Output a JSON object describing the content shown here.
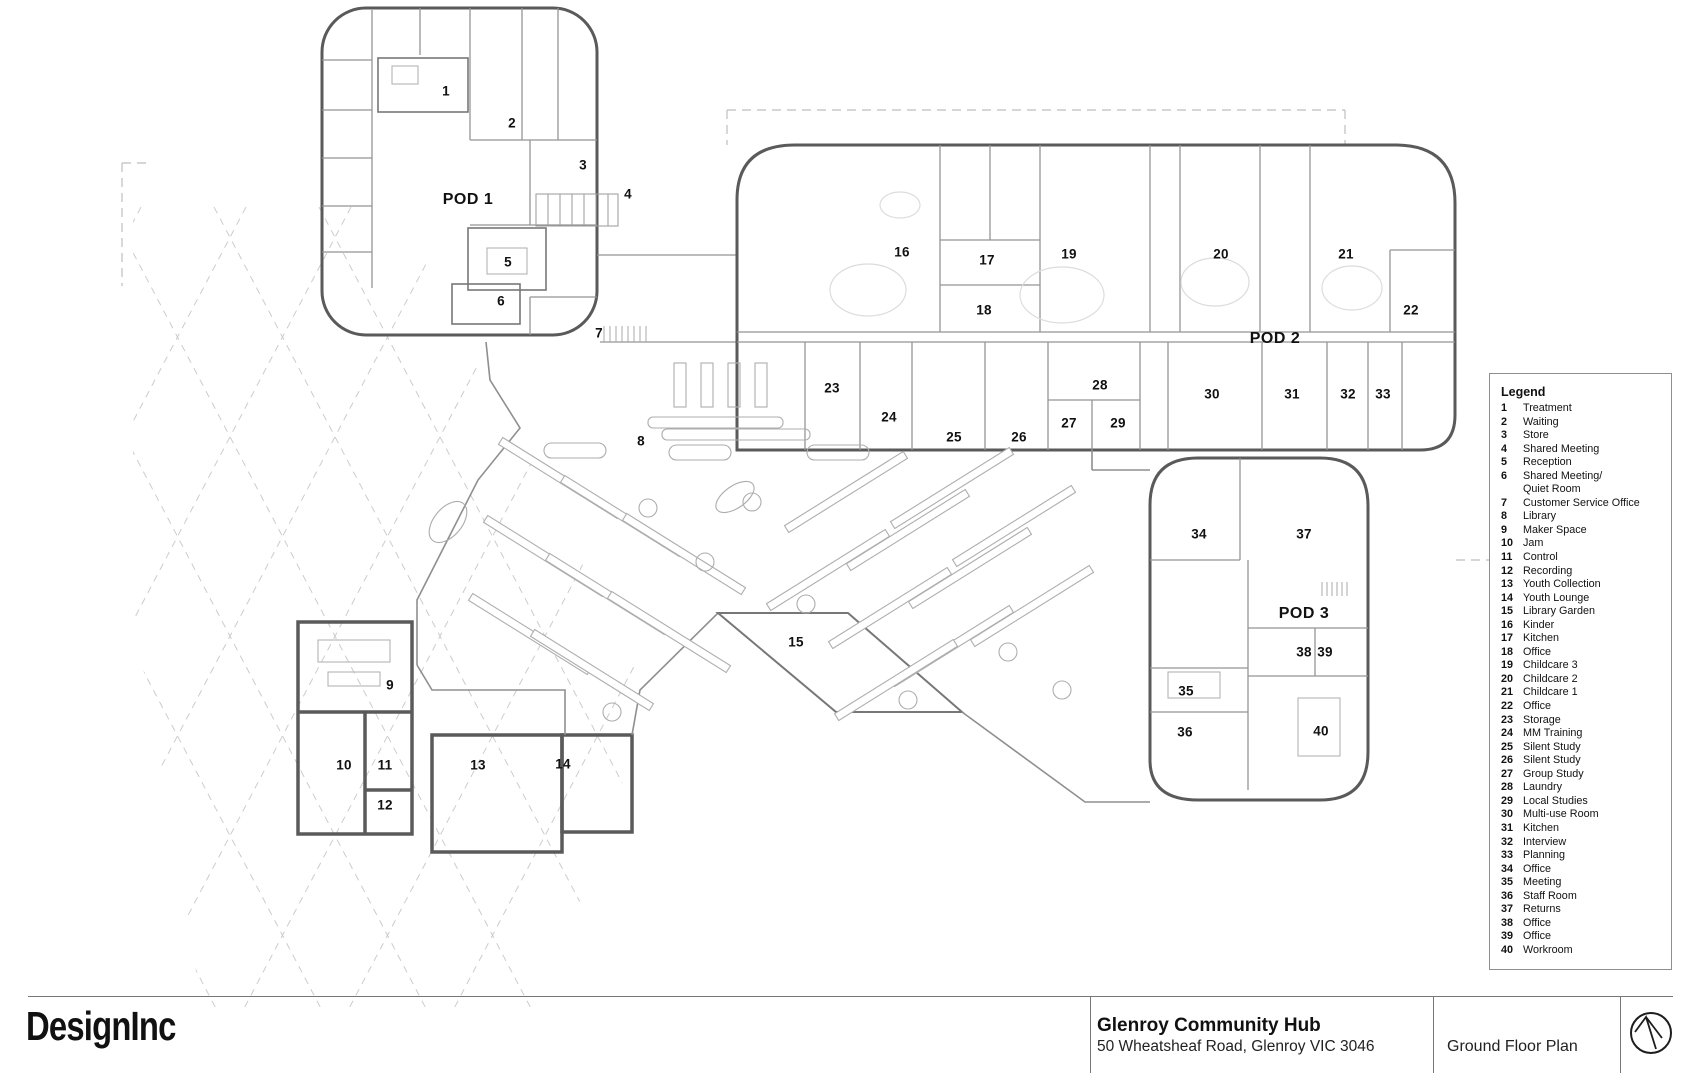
{
  "title_block": {
    "firm": "DesignInc",
    "project_name": "Glenroy Community Hub",
    "project_address": "50 Wheatsheaf Road, Glenroy VIC 3046",
    "sheet_name": "Ground Floor Plan",
    "north_arrow_icon": "north-arrow-icon"
  },
  "legend": {
    "title": "Legend",
    "entries": [
      {
        "num": "1",
        "label": "Treatment"
      },
      {
        "num": "2",
        "label": "Waiting"
      },
      {
        "num": "3",
        "label": "Store"
      },
      {
        "num": "4",
        "label": "Shared Meeting"
      },
      {
        "num": "5",
        "label": "Reception"
      },
      {
        "num": "6",
        "label": "Shared Meeting/\nQuiet Room"
      },
      {
        "num": "7",
        "label": "Customer Service Office"
      },
      {
        "num": "8",
        "label": "Library"
      },
      {
        "num": "9",
        "label": "Maker Space"
      },
      {
        "num": "10",
        "label": "Jam"
      },
      {
        "num": "11",
        "label": "Control"
      },
      {
        "num": "12",
        "label": "Recording"
      },
      {
        "num": "13",
        "label": "Youth Collection"
      },
      {
        "num": "14",
        "label": "Youth Lounge"
      },
      {
        "num": "15",
        "label": "Library Garden"
      },
      {
        "num": "16",
        "label": "Kinder"
      },
      {
        "num": "17",
        "label": "Kitchen"
      },
      {
        "num": "18",
        "label": "Office"
      },
      {
        "num": "19",
        "label": "Childcare 3"
      },
      {
        "num": "20",
        "label": "Childcare 2"
      },
      {
        "num": "21",
        "label": "Childcare 1"
      },
      {
        "num": "22",
        "label": "Office"
      },
      {
        "num": "23",
        "label": "Storage"
      },
      {
        "num": "24",
        "label": "MM Training"
      },
      {
        "num": "25",
        "label": "Silent Study"
      },
      {
        "num": "26",
        "label": "Silent Study"
      },
      {
        "num": "27",
        "label": "Group Study"
      },
      {
        "num": "28",
        "label": "Laundry"
      },
      {
        "num": "29",
        "label": "Local Studies"
      },
      {
        "num": "30",
        "label": "Multi-use Room"
      },
      {
        "num": "31",
        "label": "Kitchen"
      },
      {
        "num": "32",
        "label": "Interview"
      },
      {
        "num": "33",
        "label": "Planning"
      },
      {
        "num": "34",
        "label": "Office"
      },
      {
        "num": "35",
        "label": "Meeting"
      },
      {
        "num": "36",
        "label": "Staff Room"
      },
      {
        "num": "37",
        "label": "Returns"
      },
      {
        "num": "38",
        "label": "Office"
      },
      {
        "num": "39",
        "label": "Office"
      },
      {
        "num": "40",
        "label": "Workroom"
      }
    ]
  },
  "plan": {
    "pod_labels": [
      {
        "text": "POD 1",
        "x": 468,
        "y": 200
      },
      {
        "text": "POD 2",
        "x": 1275,
        "y": 339
      },
      {
        "text": "POD 3",
        "x": 1304,
        "y": 614
      }
    ],
    "room_numbers": [
      {
        "num": "1",
        "x": 446,
        "y": 91
      },
      {
        "num": "2",
        "x": 512,
        "y": 123
      },
      {
        "num": "3",
        "x": 583,
        "y": 165
      },
      {
        "num": "4",
        "x": 628,
        "y": 194
      },
      {
        "num": "5",
        "x": 508,
        "y": 262
      },
      {
        "num": "6",
        "x": 501,
        "y": 301
      },
      {
        "num": "7",
        "x": 599,
        "y": 333
      },
      {
        "num": "8",
        "x": 641,
        "y": 441
      },
      {
        "num": "9",
        "x": 390,
        "y": 685
      },
      {
        "num": "10",
        "x": 344,
        "y": 765
      },
      {
        "num": "11",
        "x": 385,
        "y": 765
      },
      {
        "num": "12",
        "x": 385,
        "y": 805
      },
      {
        "num": "13",
        "x": 478,
        "y": 765
      },
      {
        "num": "14",
        "x": 563,
        "y": 764
      },
      {
        "num": "15",
        "x": 796,
        "y": 642
      },
      {
        "num": "16",
        "x": 902,
        "y": 252
      },
      {
        "num": "17",
        "x": 987,
        "y": 260
      },
      {
        "num": "18",
        "x": 984,
        "y": 310
      },
      {
        "num": "19",
        "x": 1069,
        "y": 254
      },
      {
        "num": "20",
        "x": 1221,
        "y": 254
      },
      {
        "num": "21",
        "x": 1346,
        "y": 254
      },
      {
        "num": "22",
        "x": 1411,
        "y": 310
      },
      {
        "num": "23",
        "x": 832,
        "y": 388
      },
      {
        "num": "24",
        "x": 889,
        "y": 417
      },
      {
        "num": "25",
        "x": 954,
        "y": 437
      },
      {
        "num": "26",
        "x": 1019,
        "y": 437
      },
      {
        "num": "27",
        "x": 1069,
        "y": 423
      },
      {
        "num": "28",
        "x": 1100,
        "y": 385
      },
      {
        "num": "29",
        "x": 1118,
        "y": 423
      },
      {
        "num": "30",
        "x": 1212,
        "y": 394
      },
      {
        "num": "31",
        "x": 1292,
        "y": 394
      },
      {
        "num": "32",
        "x": 1348,
        "y": 394
      },
      {
        "num": "33",
        "x": 1383,
        "y": 394
      },
      {
        "num": "34",
        "x": 1199,
        "y": 534
      },
      {
        "num": "35",
        "x": 1186,
        "y": 691
      },
      {
        "num": "36",
        "x": 1185,
        "y": 732
      },
      {
        "num": "37",
        "x": 1304,
        "y": 534
      },
      {
        "num": "38",
        "x": 1304,
        "y": 652
      },
      {
        "num": "39",
        "x": 1325,
        "y": 652
      },
      {
        "num": "40",
        "x": 1321,
        "y": 731
      }
    ]
  }
}
